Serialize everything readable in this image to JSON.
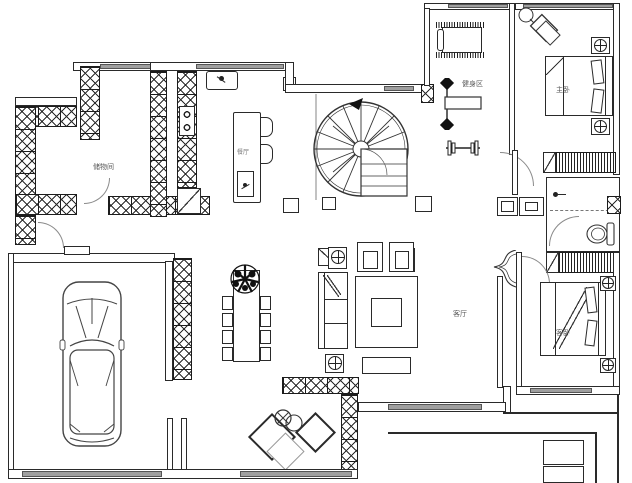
{
  "floor_plan": {
    "rooms": {
      "storage": "储物间",
      "dining": "餐厅",
      "gym": "健身区",
      "master_bedroom": "主卧",
      "living_room": "客厅",
      "guest_bedroom": "客卧"
    },
    "colors": {
      "line": "#2a2a2a",
      "window_fill": "#9f9f9f",
      "label_text": "#555555",
      "background": "#ffffff"
    },
    "icons": {
      "spiral_staircase": "spiral-staircase-icon",
      "car": "car-top-view-icon",
      "bed": "double-bed-icon",
      "toilet": "toilet-icon",
      "lamp": "circle-cross-lamp-icon",
      "treadmill": "treadmill-icon",
      "plant": "plant-icon"
    }
  }
}
